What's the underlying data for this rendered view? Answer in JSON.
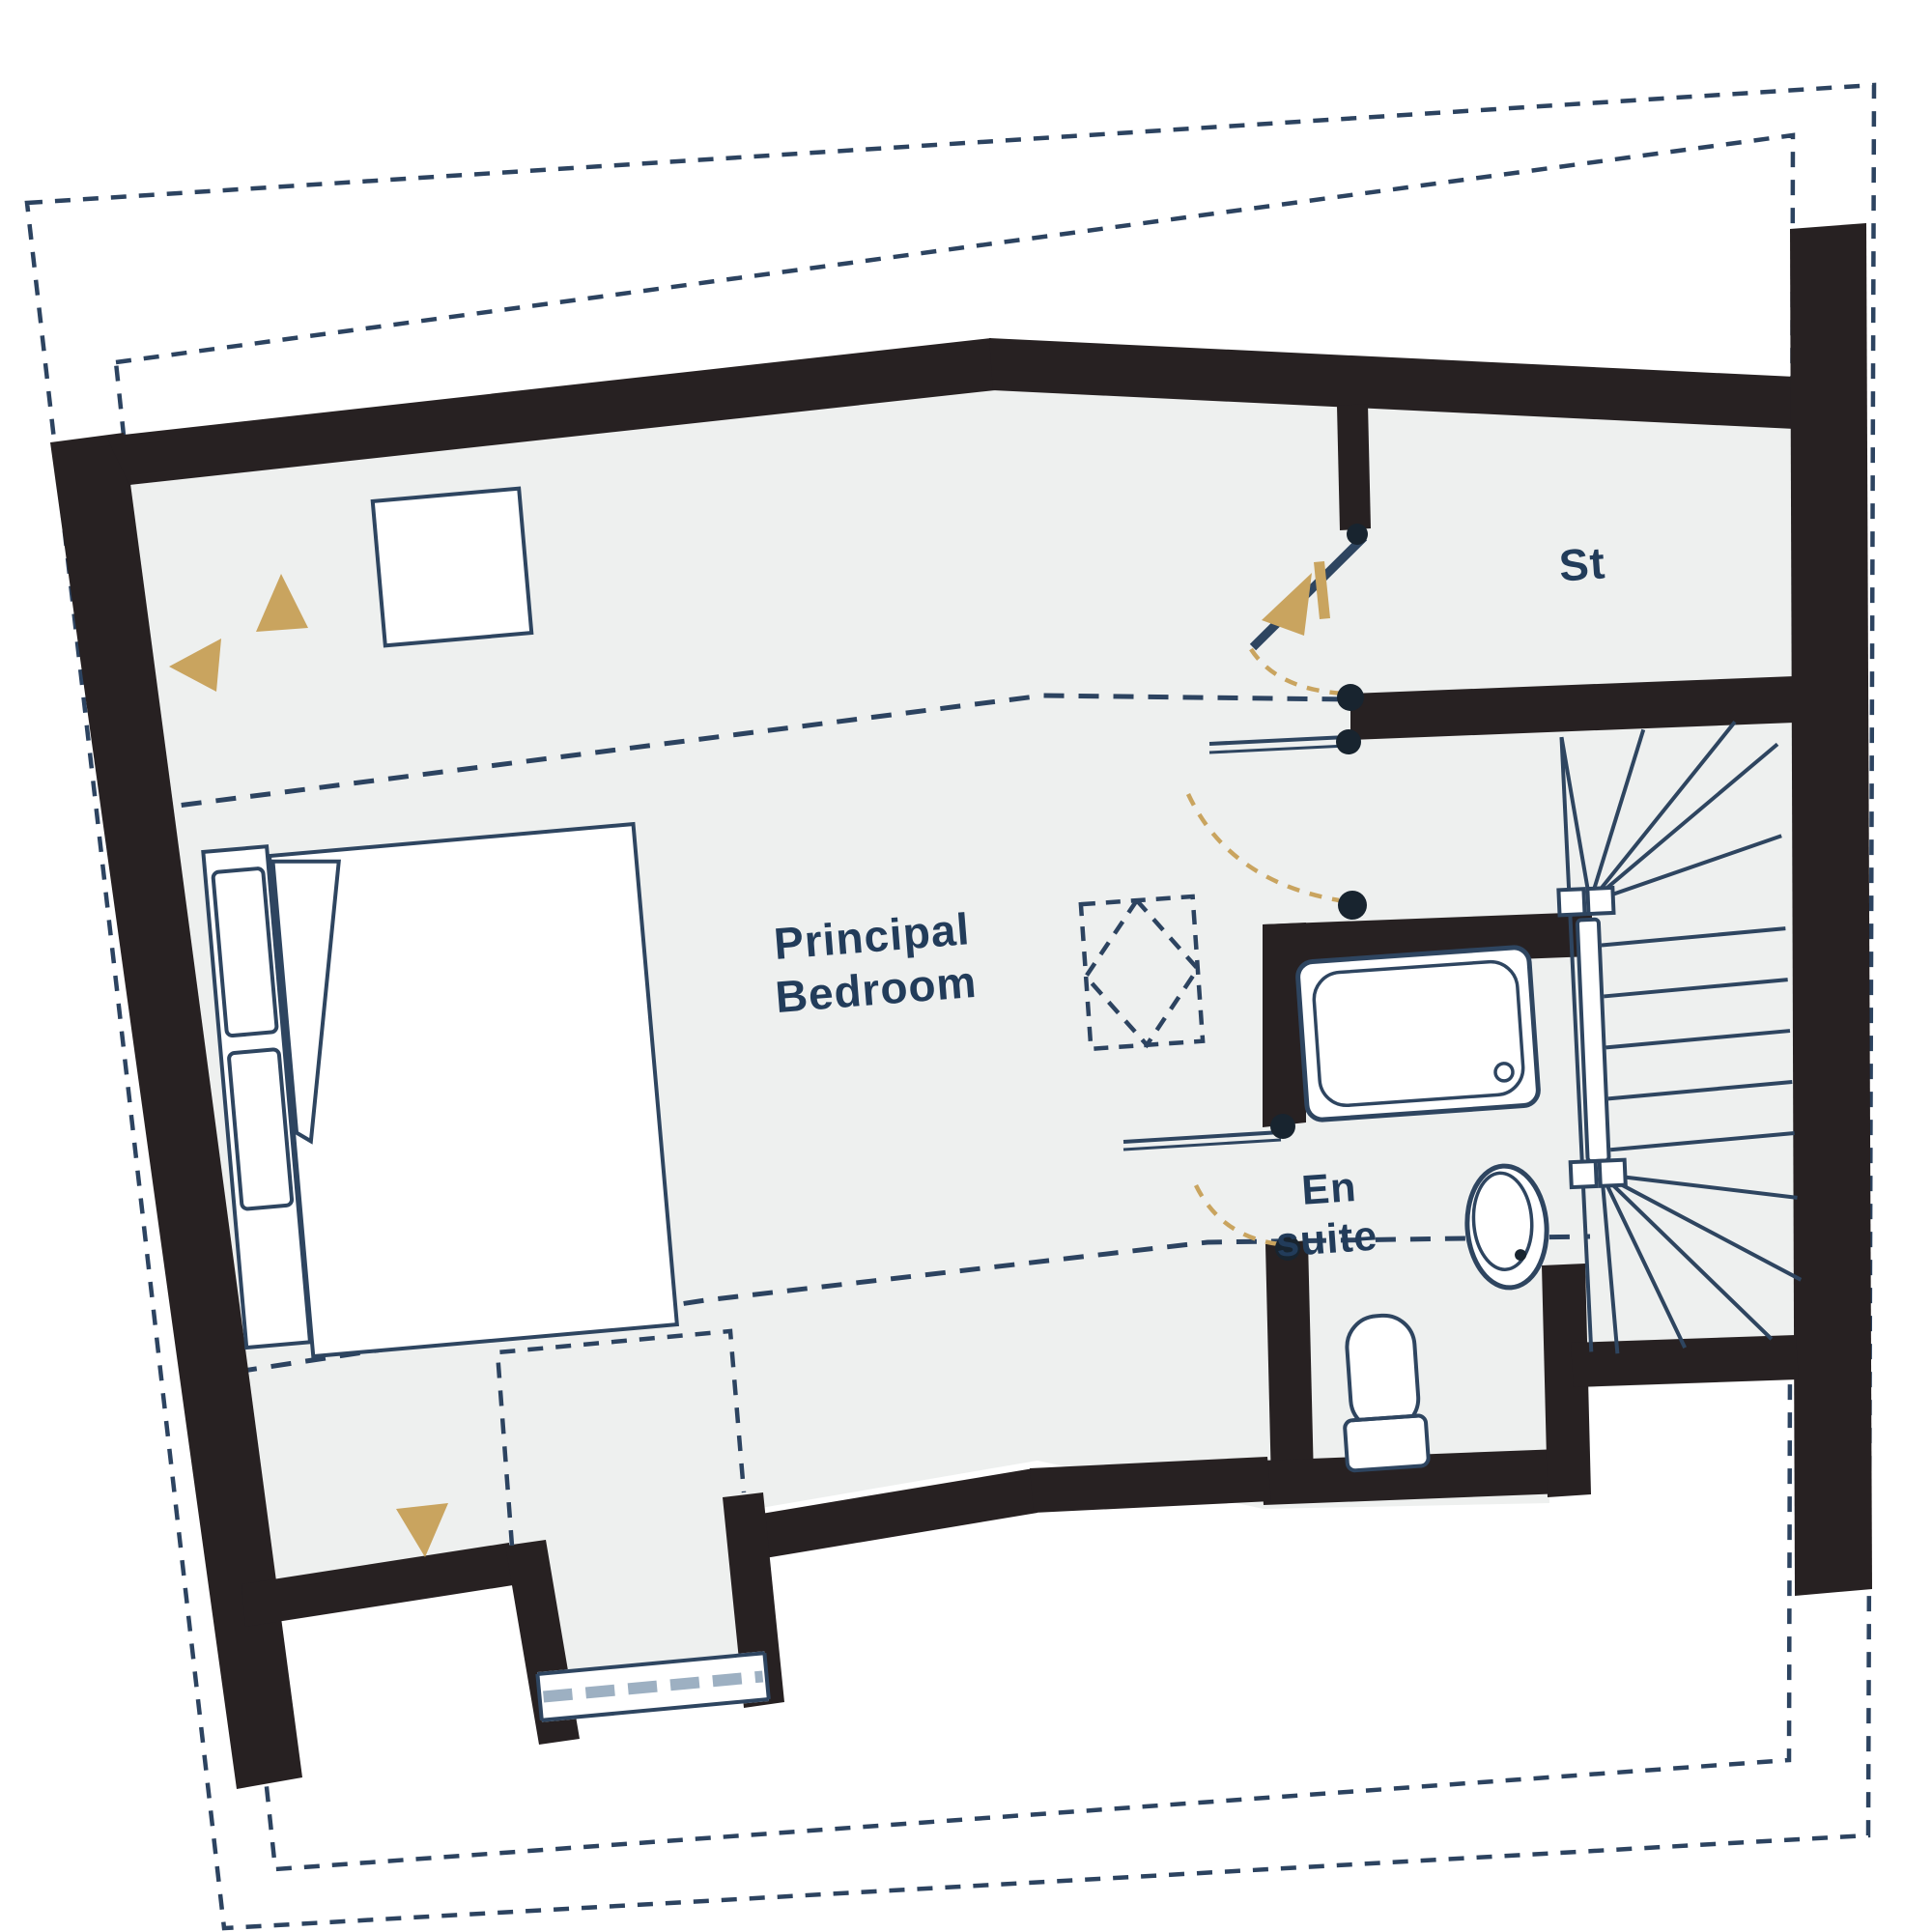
{
  "floor_plan": {
    "title": "Principal bedroom floor plan",
    "rooms": [
      {
        "id": "principal-bedroom",
        "label_line1": "Principal",
        "label_line2": "Bedroom"
      },
      {
        "id": "storage",
        "label": "St"
      },
      {
        "id": "en-suite",
        "label_line1": "En",
        "label_line2": "suite"
      }
    ],
    "fixtures": [
      "double-bed",
      "bedside-pillows",
      "bath-tub",
      "wash-basin",
      "toilet",
      "winder-staircase",
      "dormer-window",
      "rooflight",
      "skylight-symbol"
    ],
    "annotations": [
      "restricted-head-height-dashed-lines",
      "roof-eaves-dashed-outline",
      "door-swing-arcs",
      "gold-direction-arrows"
    ],
    "colors": {
      "wall": "#272122",
      "line": "#2e4560",
      "dash": "#2c4360",
      "room_fill": "#eef0ef",
      "accent_gold": "#c9a45f",
      "text": "#223c5a",
      "page": "#ffffff"
    }
  }
}
